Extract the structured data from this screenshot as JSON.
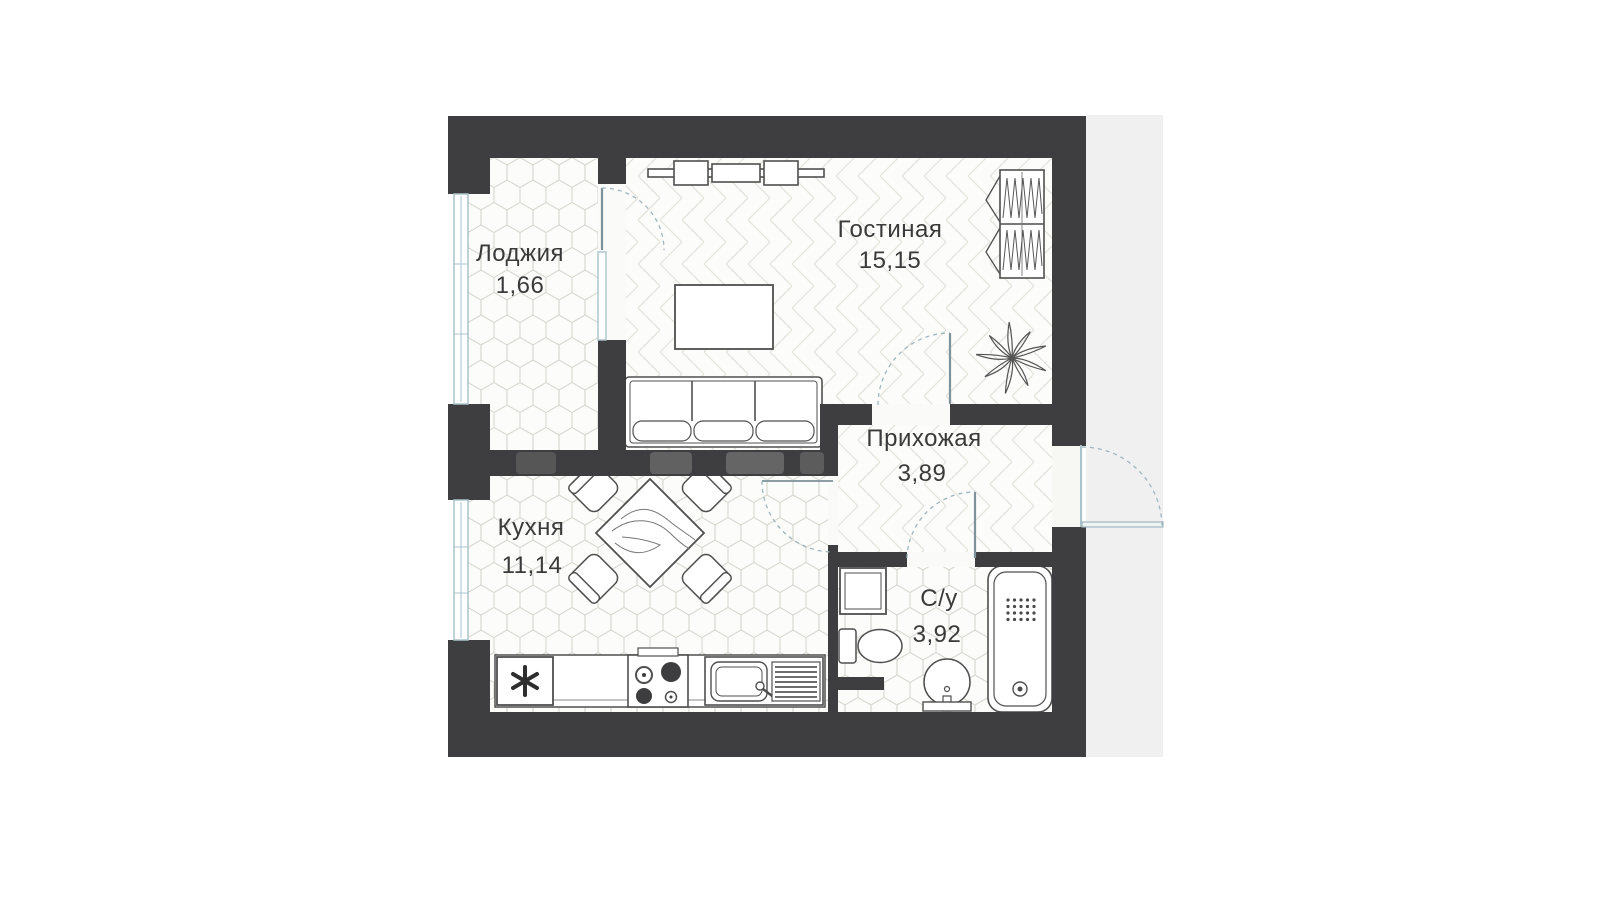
{
  "plan": {
    "type": "apartment-floor-plan",
    "rooms": [
      {
        "key": "loggia",
        "name": "Лоджия",
        "area": "1,66"
      },
      {
        "key": "living_room",
        "name": "Гостиная",
        "area": "15,15"
      },
      {
        "key": "hallway",
        "name": "Прихожая",
        "area": "3,89"
      },
      {
        "key": "kitchen",
        "name": "Кухня",
        "area": "11,14"
      },
      {
        "key": "bathroom",
        "name": "С/у",
        "area": "3,92"
      }
    ],
    "colors": {
      "walls": "#3e3d3f",
      "floor": "#fcfcfa",
      "hex_tile_lines": "#d8d8d1",
      "parquet_lines": "#e2e2da",
      "windows": "#a9c3cc",
      "door_swing": "#9fb6bf",
      "text": "#3a3a3a",
      "side_strip": "#f1f0f1"
    },
    "furniture": [
      "tv-unit",
      "coffee-table",
      "sofa",
      "wardrobe",
      "plant",
      "dining-table",
      "chair",
      "fridge",
      "stove",
      "kitchen-sink",
      "washing-machine",
      "toilet",
      "wash-basin",
      "bathtub"
    ]
  }
}
